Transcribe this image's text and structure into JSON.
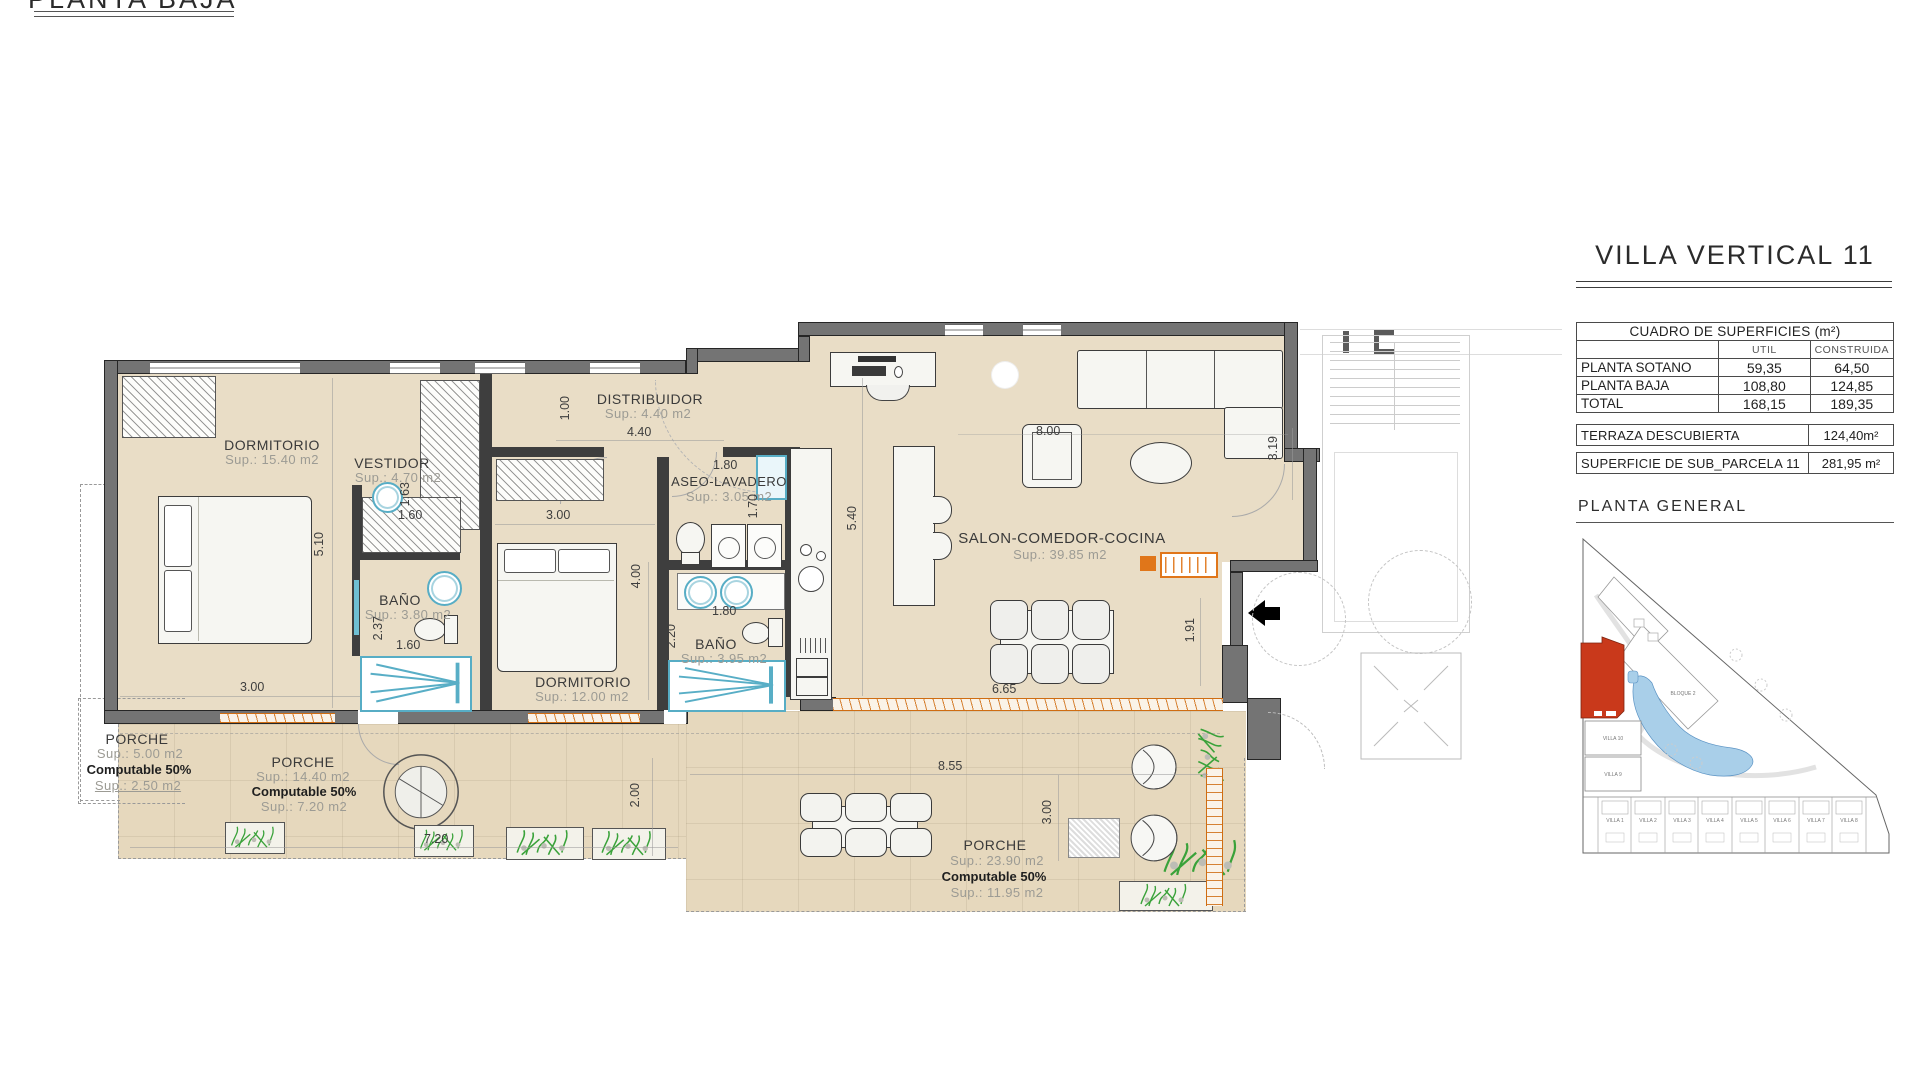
{
  "header": {
    "floor_title": "PLANTA BAJA"
  },
  "panel": {
    "villa_title": "VILLA VERTICAL 11",
    "surfaces": {
      "title": "CUADRO DE SUPERFICIES (m²)",
      "col_util": "UTIL",
      "col_construida": "CONSTRUIDA",
      "rows": [
        {
          "label": "PLANTA SOTANO",
          "util": "59,35",
          "construida": "64,50"
        },
        {
          "label": "PLANTA BAJA",
          "util": "108,80",
          "construida": "124,85"
        },
        {
          "label": "TOTAL",
          "util": "168,15",
          "construida": "189,35"
        }
      ],
      "terraza_label": "TERRAZA DESCUBIERTA",
      "terraza_value": "124,40m²",
      "parcela_label": "SUPERFICIE DE SUB_PARCELA  11",
      "parcela_value": "281,95 m²"
    },
    "site": {
      "title": "PLANTA GENERAL",
      "bloque2": "BLOQUE 2",
      "villa10": "VILLA 10",
      "villa9": "VILLA 9",
      "bottom": [
        "VILLA 1",
        "VILLA 2",
        "VILLA 3",
        "VILLA 4",
        "VILLA 5",
        "VILLA 6",
        "VILLA 7",
        "VILLA 8"
      ]
    }
  },
  "plan": {
    "watermark": "www.alicante-p",
    "rooms": {
      "dorm1": {
        "name": "DORMITORIO",
        "sup": "Sup.: 15.40  m2"
      },
      "vestidor": {
        "name": "VESTIDOR",
        "sup": "Sup.: 4.70  m2"
      },
      "distribuidor": {
        "name": "DISTRIBUIDOR",
        "sup": "Sup.: 4.40  m2"
      },
      "aseo": {
        "name": "ASEO-LAVADERO",
        "sup": "Sup.: 3.05  m2"
      },
      "bano1": {
        "name": "BAÑO",
        "sup": "Sup.: 3.80  m2"
      },
      "bano2": {
        "name": "BAÑO",
        "sup": "Sup.: 3.95  m2"
      },
      "dorm2": {
        "name": "DORMITORIO",
        "sup": "Sup.: 12.00  m2"
      },
      "salon": {
        "name": "SALON-COMEDOR-COCINA",
        "sup": "Sup.: 39.85  m2"
      },
      "porche1": {
        "name": "PORCHE",
        "sup": "Sup.: 5.00   m2",
        "comp": "Computable 50%",
        "sup2": "Sup.: 2.50   m2"
      },
      "porche2": {
        "name": "PORCHE",
        "sup": "Sup.: 14.40  m2",
        "comp": "Computable 50%",
        "sup2": "Sup.: 7.20   m2"
      },
      "porche3": {
        "name": "PORCHE",
        "sup": "Sup.: 23.90  m2",
        "comp": "Computable 50%",
        "sup2": "Sup.: 11.95  m2"
      }
    },
    "dims": {
      "d510": "5.10",
      "d300a": "3.00",
      "d163": "1.63",
      "d160a": "1.60",
      "d237": "2.37",
      "d160b": "1.60",
      "d100": "1.00",
      "d440": "4.40",
      "d300b": "3.00",
      "d400": "4.00",
      "d180a": "1.80",
      "d170": "1.70",
      "d180b": "1.80",
      "d220": "2.20",
      "d540": "5.40",
      "d800": "8.00",
      "d319": "3.19",
      "d191": "1.91",
      "d665": "6.65",
      "d855": "8.55",
      "d300c": "3.00",
      "d720": "7.20",
      "d200": "2.00"
    }
  }
}
